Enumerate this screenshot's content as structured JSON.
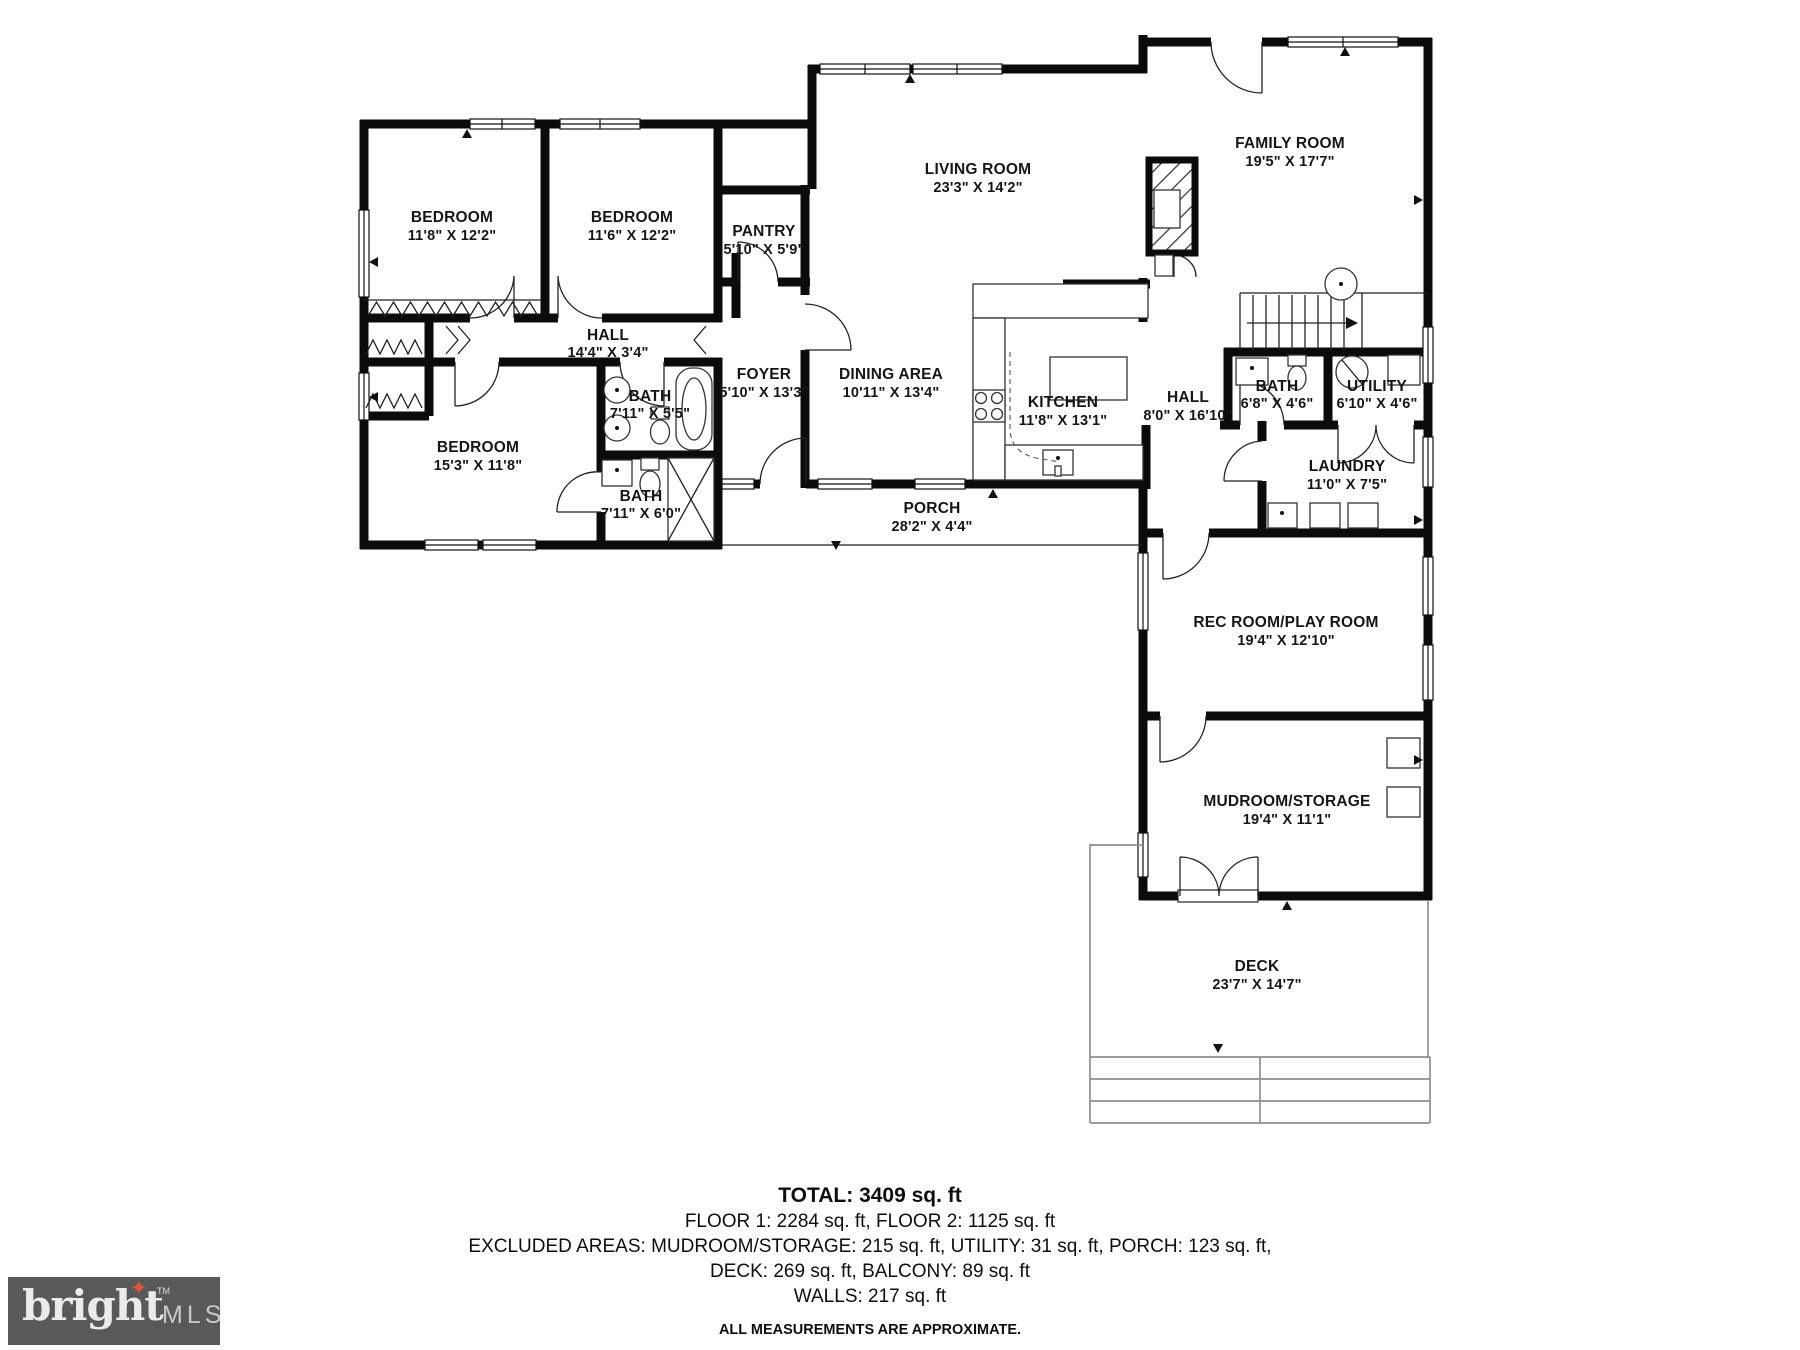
{
  "rooms": {
    "bedroom1": {
      "name": "BEDROOM",
      "dims": "11'8\" X 12'2\""
    },
    "bedroom2": {
      "name": "BEDROOM",
      "dims": "11'6\" X 12'2\""
    },
    "bedroom3": {
      "name": "BEDROOM",
      "dims": "15'3\" X 11'8\""
    },
    "pantry": {
      "name": "PANTRY",
      "dims": "5'10\" X 5'9\""
    },
    "hall1": {
      "name": "HALL",
      "dims": "14'4\" X 3'4\""
    },
    "bath1": {
      "name": "BATH",
      "dims": "7'11\" X 5'5\""
    },
    "bath2": {
      "name": "BATH",
      "dims": "7'11\" X 6'0\""
    },
    "foyer": {
      "name": "FOYER",
      "dims": "5'10\" X 13'3\""
    },
    "living": {
      "name": "LIVING ROOM",
      "dims": "23'3\" X 14'2\""
    },
    "dining": {
      "name": "DINING AREA",
      "dims": "10'11\" X 13'4\""
    },
    "kitchen": {
      "name": "KITCHEN",
      "dims": "11'8\" X 13'1\""
    },
    "family": {
      "name": "FAMILY ROOM",
      "dims": "19'5\" X 17'7\""
    },
    "hall2": {
      "name": "HALL",
      "dims": "8'0\" X 16'10\""
    },
    "bath3": {
      "name": "BATH",
      "dims": "6'8\" X 4'6\""
    },
    "utility": {
      "name": "UTILITY",
      "dims": "6'10\" X 4'6\""
    },
    "laundry": {
      "name": "LAUNDRY",
      "dims": "11'0\" X 7'5\""
    },
    "porch": {
      "name": "PORCH",
      "dims": "28'2\" X 4'4\""
    },
    "rec": {
      "name": "REC ROOM/PLAY ROOM",
      "dims": "19'4\" X 12'10\""
    },
    "mudroom": {
      "name": "MUDROOM/STORAGE",
      "dims": "19'4\" X 11'1\""
    },
    "deck": {
      "name": "DECK",
      "dims": "23'7\" X 14'7\""
    }
  },
  "summary": {
    "total": "TOTAL: 3409 sq. ft",
    "floors": "FLOOR 1: 2284 sq. ft, FLOOR 2: 1125 sq. ft",
    "excluded1": "EXCLUDED AREAS: MUDROOM/STORAGE: 215 sq. ft, UTILITY: 31 sq. ft, PORCH: 123 sq. ft,",
    "excluded2": "DECK: 269 sq. ft, BALCONY: 89 sq. ft",
    "walls": "WALLS: 217 sq. ft",
    "disclaimer": "ALL MEASUREMENTS ARE APPROXIMATE."
  },
  "branding": {
    "logo_text": "bright",
    "logo_tm": "TM",
    "logo_suffix": "MLS",
    "logo_bg": "#58595b",
    "logo_accent": "#e8542d"
  },
  "colors": {
    "wall": "#0b0b0b",
    "background": "#ffffff"
  }
}
